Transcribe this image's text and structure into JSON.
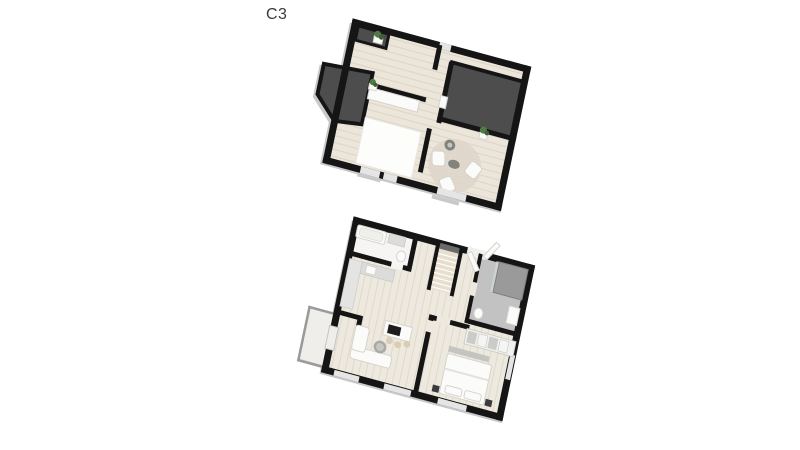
{
  "title": {
    "label": "C3"
  },
  "figure": {
    "floor_plans": [
      {
        "id": "upper-floor-plan"
      },
      {
        "id": "lower-floor-plan"
      }
    ]
  },
  "colors": {
    "background": "#ffffff",
    "text": "#3a3a3a",
    "wall": "#151515",
    "wall-side": "#c9c9c9",
    "roof": "#4d4d4d",
    "floor": "#ebe5da",
    "floor-line": "#ddd4c5",
    "floor2": "#eee9df",
    "floor2-line": "#e0d8ca",
    "white-furniture": "#fbfbfa",
    "furniture-line": "#d5d3cd",
    "gray-furniture": "#dcdcda",
    "dark-furniture": "#3b3b3b",
    "tile": "#c2c2c2",
    "shower": "#9a9a9a",
    "stairs": "#e8decd",
    "landing": "#6a6a6a",
    "window": "#e5e5e5",
    "railing": "#9a9a9a",
    "rug": "#ded6c9",
    "plant": "#4e7a44",
    "plant-dark": "#3c6136",
    "stool": "#d9cdb4",
    "cooktop": "#1d1d1d",
    "pouf": "#83837e",
    "balcony-floor": "#efeeea",
    "bath-floor": "#f6f5f3",
    "table-top": "#a9a9a5",
    "table-inner": "#c6c6c2"
  }
}
